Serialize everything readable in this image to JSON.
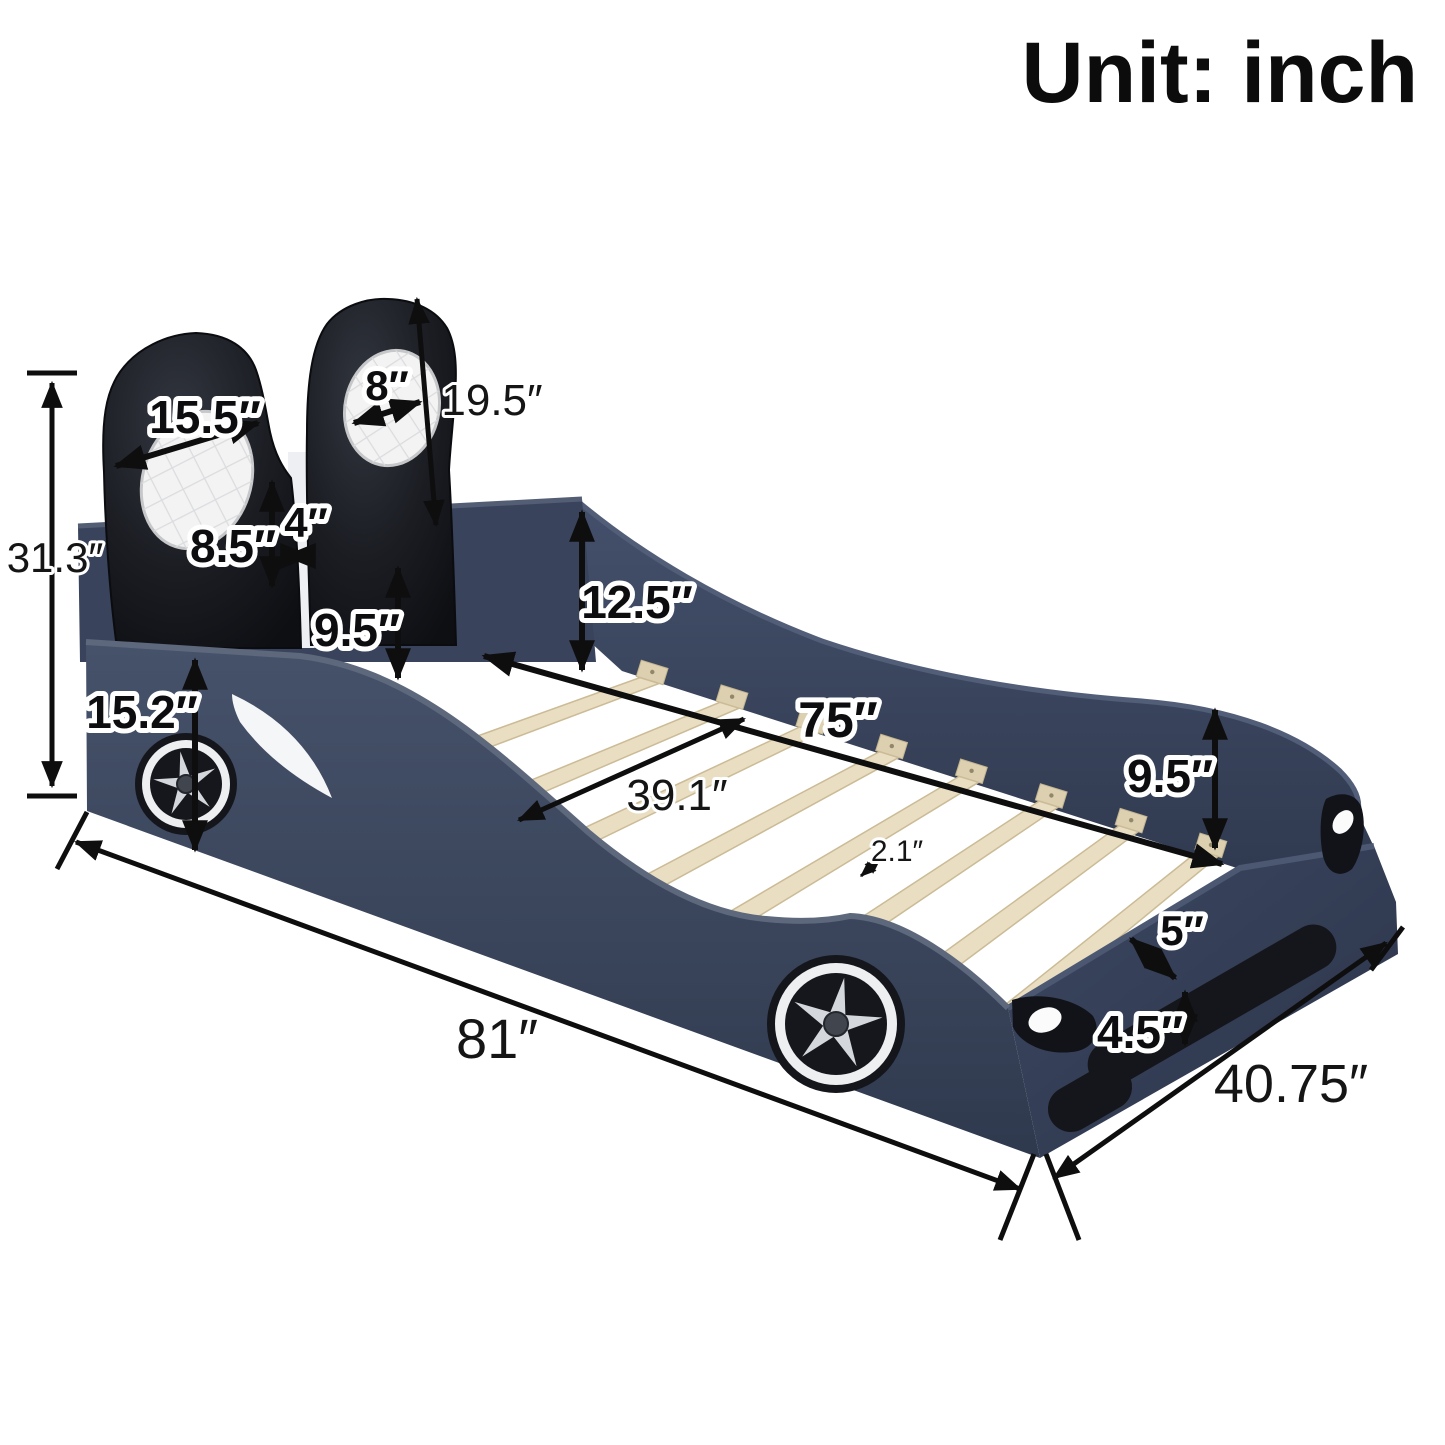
{
  "title": "Unit: inch",
  "labels": {
    "headrest_width": "15.5″",
    "headrest_pad_width": "8″",
    "headrest_height": "19.5″",
    "headrest_gap_width": "4″",
    "headrest_lower_height": "8.5″",
    "total_height": "31.3″",
    "front_panel_height": "15.2″",
    "headboard_rail_height": "9.5″",
    "side_rail_height": "12.5″",
    "slat_area_length": "75″",
    "inner_width": "39.1″",
    "slat_width": "2.1″",
    "tail_rail_height": "9.5″",
    "tail_ledge_depth": "5″",
    "footboard_height": "4.5″",
    "total_length": "81″",
    "total_width": "40.75″"
  },
  "colors": {
    "body": "#3A4458",
    "body-dark": "#303A4F",
    "body-edge": "#5D687D",
    "far": "#3D4860",
    "foot": "#36415A",
    "black-part": "#14161B",
    "slat": "#E9DEC1",
    "block": "#DCD0B1",
    "rim": "#EDEFF1",
    "star": "#D4D7DB",
    "pad": "#F3F3F4",
    "connector": "#EDEFF2",
    "ink": "#0e0e0f"
  }
}
